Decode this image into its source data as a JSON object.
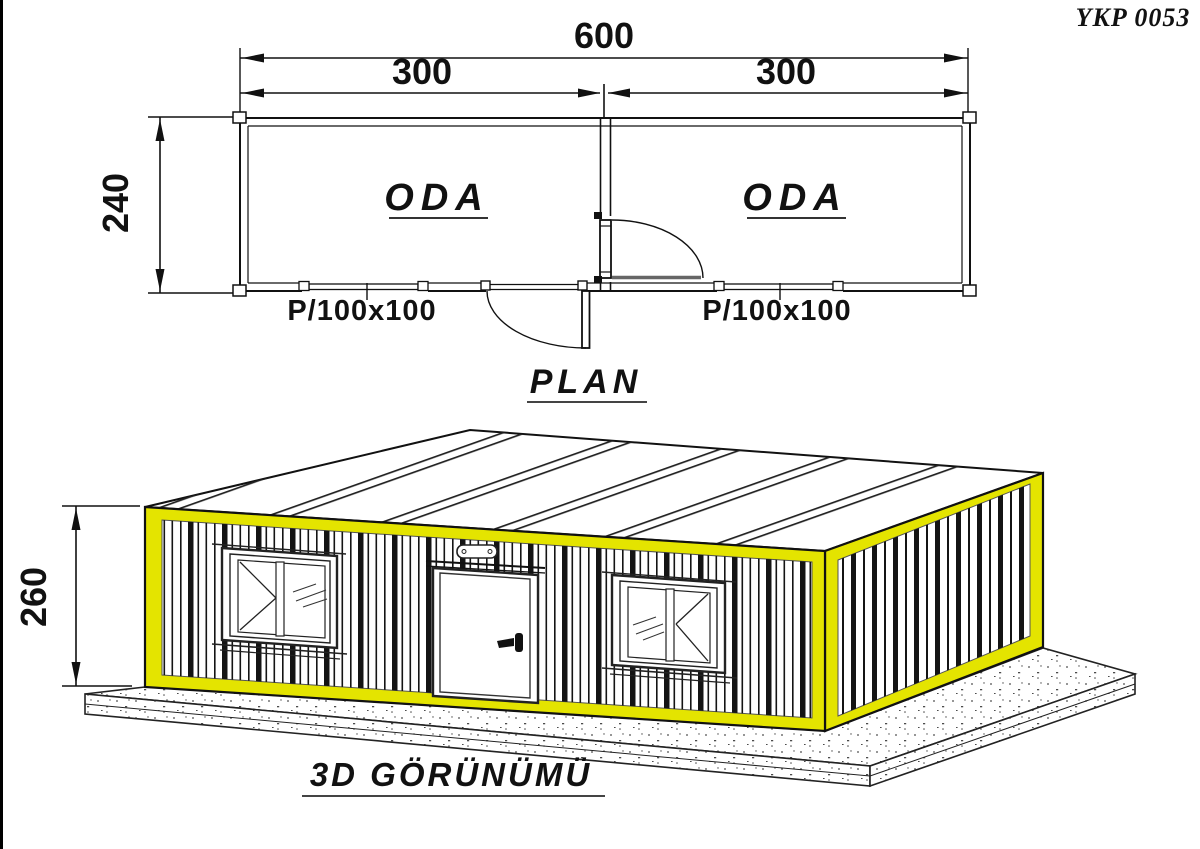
{
  "page": {
    "drawing_number": "YKP 0053"
  },
  "plan": {
    "title": "PLAN",
    "dim_width_total": "600",
    "dim_width_left": "300",
    "dim_width_right": "300",
    "dim_depth": "240",
    "room_left_label": "ODA",
    "room_right_label": "ODA",
    "window_left_label": "P/100x100",
    "window_right_label": "P/100x100"
  },
  "view3d": {
    "title": "3D GÖRÜNÜMÜ",
    "dim_height": "260"
  },
  "colors": {
    "accent_yellow": "#e4e400",
    "line_black": "#111111",
    "speckle_gray": "#2b2b2b"
  }
}
